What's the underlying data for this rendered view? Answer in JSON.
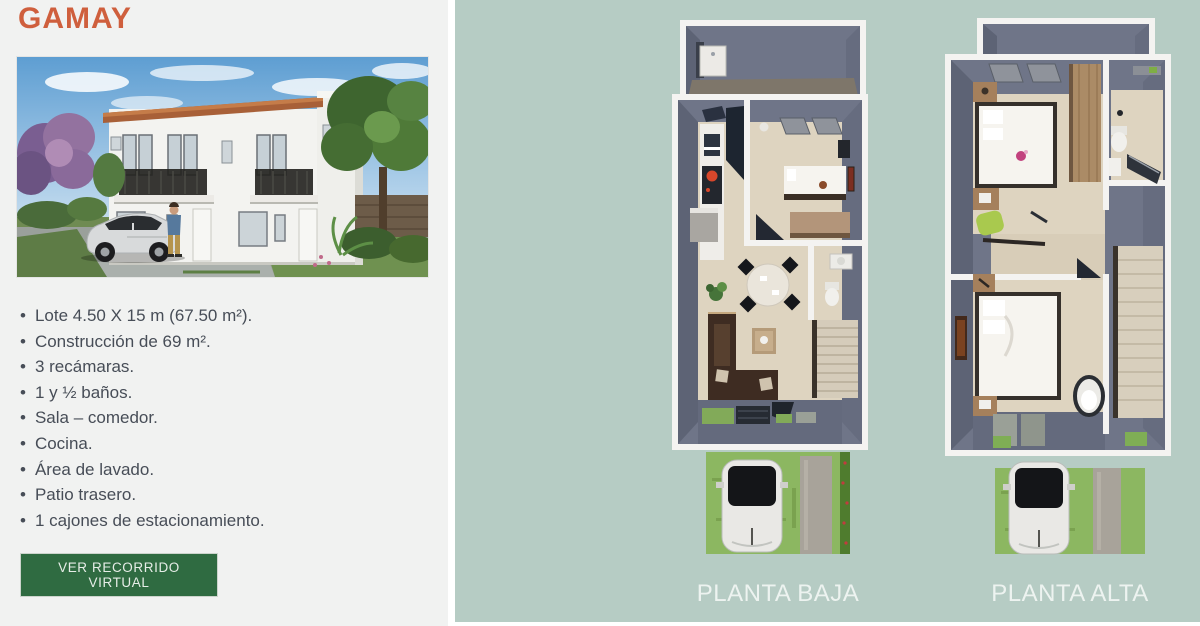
{
  "listing": {
    "title": "GAMAY",
    "features": [
      "Lote 4.50 X 15 m (67.50 m²).",
      "Construcción de 69 m².",
      "3 recámaras.",
      "1 y ½ baños.",
      "Sala – comedor.",
      "Cocina.",
      "Área de lavado.",
      "Patio trasero.",
      "1 cajones de estacionamiento."
    ],
    "cta_label": "VER RECORRIDO VIRTUAL"
  },
  "floorplans": {
    "ground_label": "PLANTA BAJA",
    "upper_label": "PLANTA ALTA"
  },
  "colors": {
    "title_color": "#cf5f3d",
    "panel_bg": "#f1f2f1",
    "plans_bg": "#b6ccc4",
    "button_bg": "#2f6b41",
    "button_text": "#e6ede7",
    "body_text": "#474d57",
    "label_text": "#edf3f0",
    "plan_wall": "#6f7588",
    "plan_floor": "#ded4c0",
    "grass": "#8cb761"
  }
}
